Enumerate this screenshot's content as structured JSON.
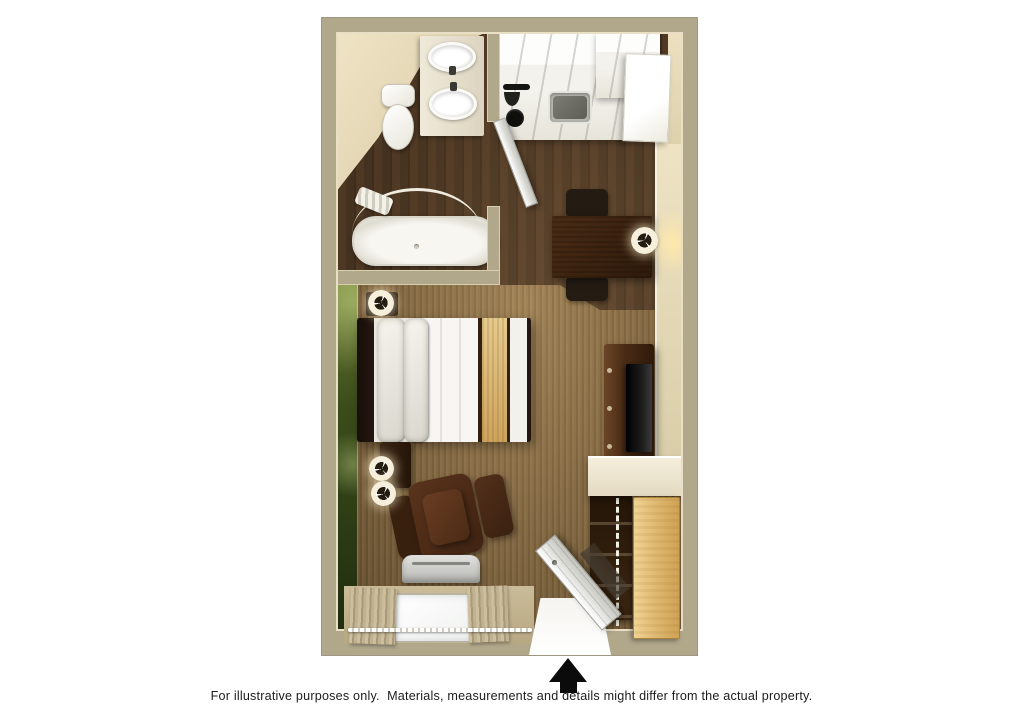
{
  "caption": "For illustrative purposes only.  Materials, measurements and details might differ from the actual property.",
  "plan": {
    "type": "studio-floor-plan",
    "entrance_marker": "up-arrow",
    "rooms": [
      {
        "name": "bathroom",
        "items": [
          "toilet",
          "double-sink-vanity",
          "bathtub",
          "curved-shower-rod",
          "shower-curtain",
          "bathroom-door"
        ]
      },
      {
        "name": "kitchen",
        "items": [
          "counter-cabinets",
          "stove-burners",
          "stainless-sink",
          "refrigerator"
        ]
      },
      {
        "name": "dining-area",
        "items": [
          "dining-table",
          "dining-chair",
          "dining-chair",
          "table-lamp"
        ]
      },
      {
        "name": "sleeping-living-area",
        "items": [
          "bed",
          "headboard",
          "pillows",
          "gold-bed-runner",
          "nightstand",
          "lamps",
          "armchair",
          "ottoman",
          "tv-console",
          "tv",
          "ac-unit",
          "window",
          "curtains",
          "green-accent-wall"
        ]
      },
      {
        "name": "closet",
        "items": [
          "sliding-door",
          "shelves",
          "hanging-rod"
        ]
      },
      {
        "name": "entry",
        "items": [
          "entry-door",
          "doorway"
        ]
      }
    ],
    "colors": {
      "background": "#ffffff",
      "wall": "#b1a88c",
      "wall_inner_face": "#e9dfc4",
      "accent_wall_green": "#3c4d1b",
      "carpet": "#8a6c42",
      "wood_floor": "#46321f",
      "bed_runner_gold": "#d9bc80",
      "dark_wood_furniture": "#3a2313",
      "closet_door_tan": "#e2bd76",
      "arrow": "#0b0b0b"
    }
  }
}
